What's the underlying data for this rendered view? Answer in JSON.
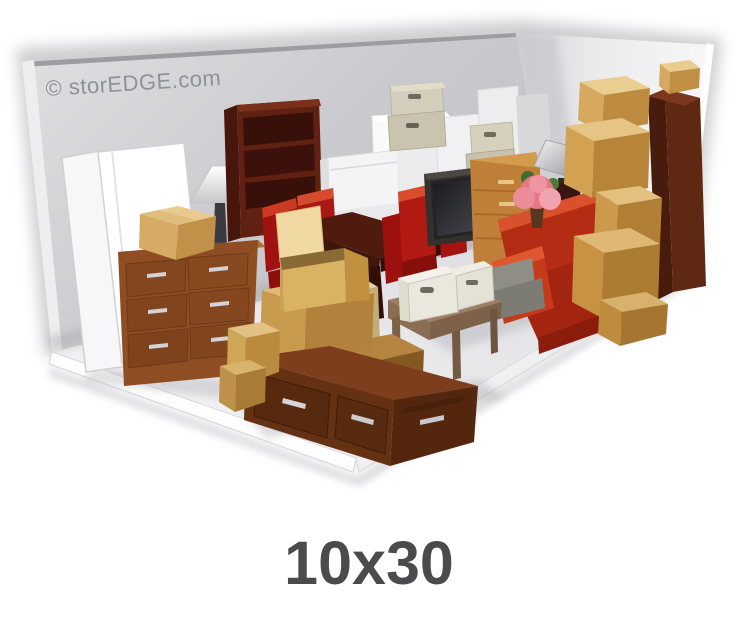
{
  "caption": {
    "label": "10x30"
  },
  "illustration": {
    "watermark": "© storEDGE.com",
    "unit_size": "10x30",
    "items": [
      "leaning mattresses",
      "table lamp",
      "bookshelf",
      "wood dresser",
      "cardboard boxes",
      "dining table",
      "red chairs",
      "washer and dryer",
      "storage bins",
      "television",
      "orange dresser",
      "red sofa",
      "pink potted plant",
      "metal floor lamp",
      "tall wardrobe",
      "rolled gray mattress",
      "side table",
      "white storage totes",
      "dark storage chest"
    ],
    "colors": {
      "back_wall": "#c9c9cd",
      "right_wall": "#f2f2f5",
      "floor": "#e9e9ec",
      "cardboard": "#d7a95e",
      "wood_dark": "#5f2113",
      "wood_medium": "#8e4d22",
      "sofa_red": "#c03018",
      "chair_red": "#a81410",
      "bin_beige": "#cfc9b5",
      "caption_text": "#4b4b4e",
      "watermark_text": "#90909a"
    }
  }
}
